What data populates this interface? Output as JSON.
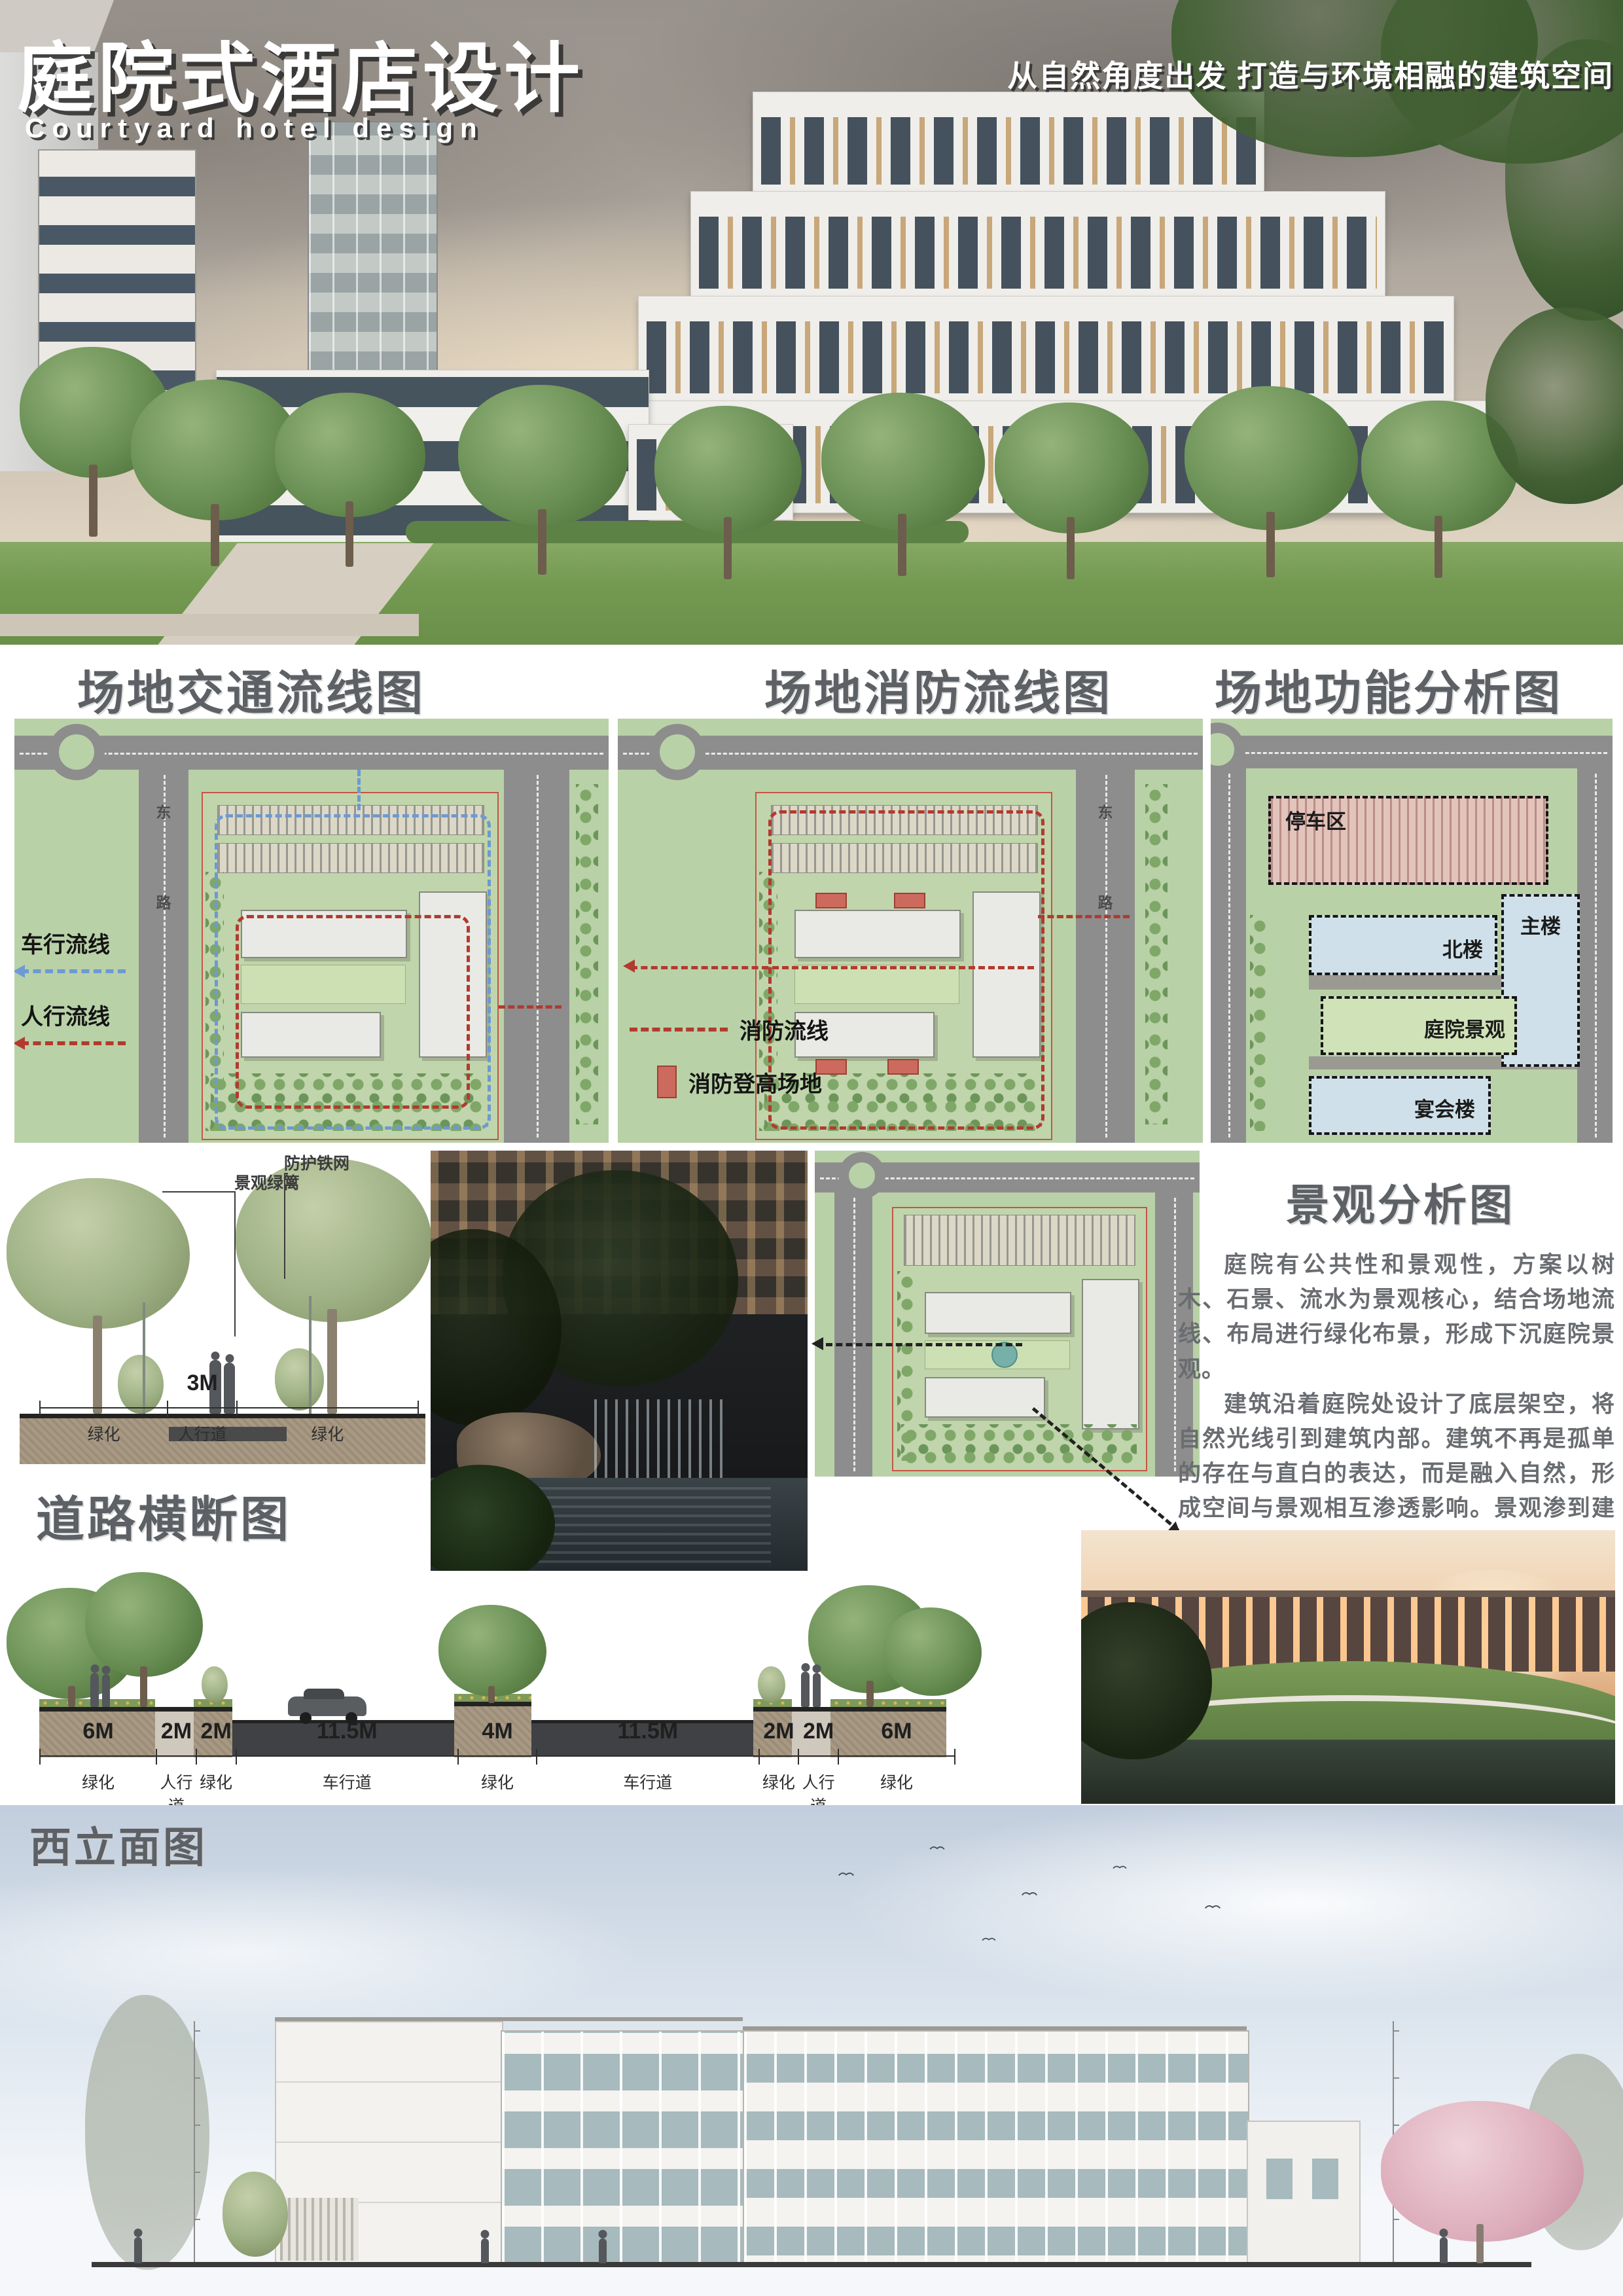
{
  "poster": {
    "title_cn": "庭院式酒店设计",
    "title_en": "Courtyard hotel design",
    "slogan": "从自然角度出发 打造与环境相融的建筑空间"
  },
  "sections": {
    "traffic": "场地交通流线图",
    "fire": "场地消防流线图",
    "function": "场地功能分析图",
    "landscape": "景观分析图",
    "road_section": "道路横断图",
    "west_elevation": "西立面图"
  },
  "legend": {
    "vehicle_flow": "车行流线",
    "pedestrian_flow": "人行流线",
    "fire_flow": "消防流线",
    "fire_platform": "消防登高场地"
  },
  "zones": {
    "parking": "停车区",
    "north_building": "北楼",
    "main_building": "主楼",
    "courtyard_landscape": "庭院景观",
    "banquet_building": "宴会楼"
  },
  "road_name": {
    "char1": "东",
    "char2": "路"
  },
  "tree_section": {
    "label_hedge": "景观绿篱",
    "label_fence": "防护铁网",
    "dim_value": "3M",
    "seg_left": "绿化",
    "seg_mid": "人行道",
    "seg_right": "绿化"
  },
  "landscape": {
    "para1": "庭院有公共性和景观性，方案以树木、石景、流水为景观核心，结合场地流线、布局进行绿化布景，形成下沉庭院景观。",
    "para2": "建筑沿着庭院处设计了底层架空，将自然光线引到建筑内部。建筑不再是孤单的存在与直白的表达，而是融入自然，形成空间与景观相互渗透影响。景观渗到建筑室内中，好似人与景观在对话。"
  },
  "road_dims": [
    {
      "width": "6M",
      "label": "绿化"
    },
    {
      "width": "2M",
      "label": "人行道"
    },
    {
      "width": "2M",
      "label": "绿化"
    },
    {
      "width": "11.5M",
      "label": "车行道"
    },
    {
      "width": "4M",
      "label": "绿化"
    },
    {
      "width": "11.5M",
      "label": "车行道"
    },
    {
      "width": "2M",
      "label": "绿化"
    },
    {
      "width": "2M",
      "label": "人行道"
    },
    {
      "width": "6M",
      "label": "绿化"
    }
  ],
  "colors": {
    "header_grey": "#5d6165",
    "plan_green": "#b9d1a7",
    "road_grey": "#8d8d8d",
    "vehicle_blue": "#6d9ad2",
    "route_red": "#b23a2e",
    "parking_pink": "#e2c4bc",
    "building_blue": "#cfe0ea"
  }
}
